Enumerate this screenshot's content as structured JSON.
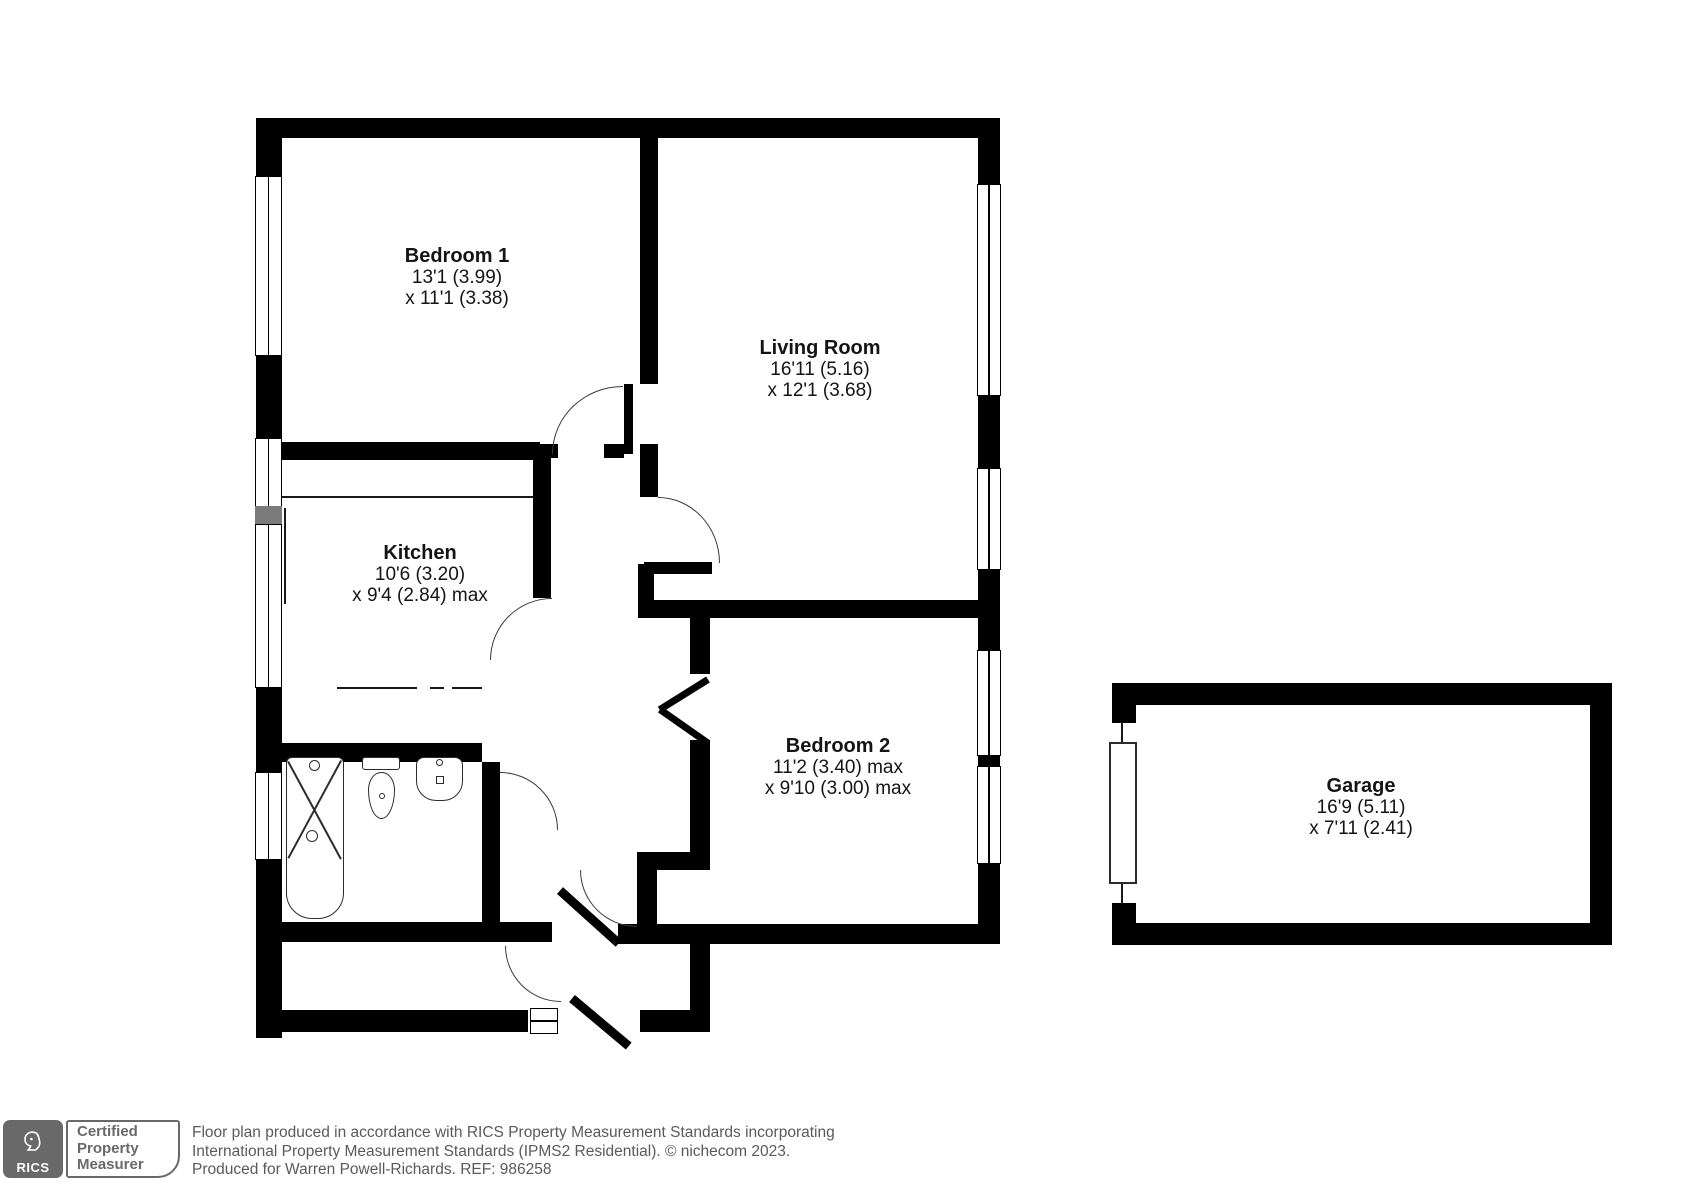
{
  "rooms": {
    "bedroom1": {
      "name": "Bedroom 1",
      "dim1": "13'1 (3.99)",
      "dim2": "x 11'1 (3.38)"
    },
    "living": {
      "name": "Living Room",
      "dim1": "16'11 (5.16)",
      "dim2": "x 12'1 (3.68)"
    },
    "kitchen": {
      "name": "Kitchen",
      "dim1": "10'6 (3.20)",
      "dim2": "x 9'4 (2.84) max"
    },
    "bedroom2": {
      "name": "Bedroom 2",
      "dim1": "11'2 (3.40) max",
      "dim2": "x 9'10 (3.00) max"
    },
    "garage": {
      "name": "Garage",
      "dim1": "16'9 (5.11)",
      "dim2": "x 7'11 (2.41)"
    }
  },
  "footer": {
    "rics": "RICS",
    "badge_line1": "Certified",
    "badge_line2": "Property",
    "badge_line3": "Measurer",
    "disclaimer1": "Floor plan produced in accordance with RICS Property Measurement Standards incorporating",
    "disclaimer2": "International Property Measurement Standards (IPMS2 Residential).   © nichecom 2023.",
    "disclaimer3": "Produced for Warren Powell-Richards.   REF:  986258"
  },
  "colors": {
    "wall": "#000000",
    "fixture": "#2b2b2b",
    "footer_gray": "#696969"
  }
}
